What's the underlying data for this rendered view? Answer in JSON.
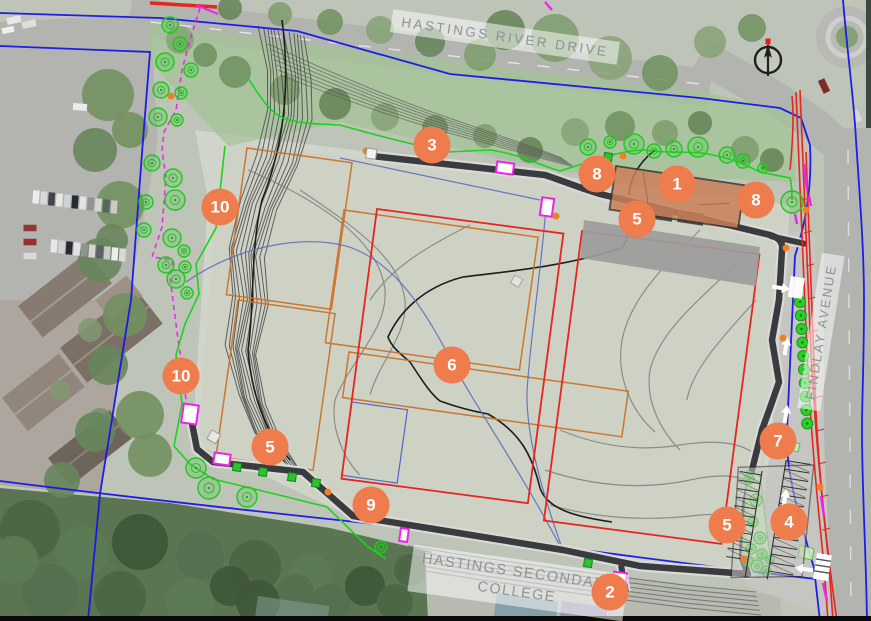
{
  "map": {
    "streets": {
      "hastings_river_drive": "HASTINGS RIVER DRIVE",
      "findlay_avenue": "FINDLAY AVENUE"
    },
    "college_lines": [
      "HASTINGS SECONDARY",
      "COLLEGE"
    ],
    "markers": [
      {
        "n": "1",
        "x": 677,
        "y": 184
      },
      {
        "n": "2",
        "x": 610,
        "y": 592
      },
      {
        "n": "3",
        "x": 432,
        "y": 145
      },
      {
        "n": "4",
        "x": 789,
        "y": 522
      },
      {
        "n": "5",
        "x": 637,
        "y": 219
      },
      {
        "n": "5",
        "x": 270,
        "y": 447
      },
      {
        "n": "5",
        "x": 727,
        "y": 525
      },
      {
        "n": "6",
        "x": 452,
        "y": 365
      },
      {
        "n": "7",
        "x": 778,
        "y": 441
      },
      {
        "n": "8",
        "x": 597,
        "y": 174
      },
      {
        "n": "8",
        "x": 756,
        "y": 200
      },
      {
        "n": "9",
        "x": 371,
        "y": 505
      },
      {
        "n": "10",
        "x": 220,
        "y": 207
      },
      {
        "n": "10",
        "x": 181,
        "y": 376
      }
    ],
    "icons": {
      "compass": "north-compass-icon"
    },
    "colors": {
      "marker_orange": "#ee7c4d",
      "boundary_blue": "#1616e8",
      "proposed_field_red": "#e52520",
      "existing_field_orange": "#cc7227",
      "landscape_green": "#1ecb1e",
      "fence_magenta": "#ee22ee",
      "path_grey": "#3a3b3e",
      "building_tan": "#c9805a"
    }
  }
}
